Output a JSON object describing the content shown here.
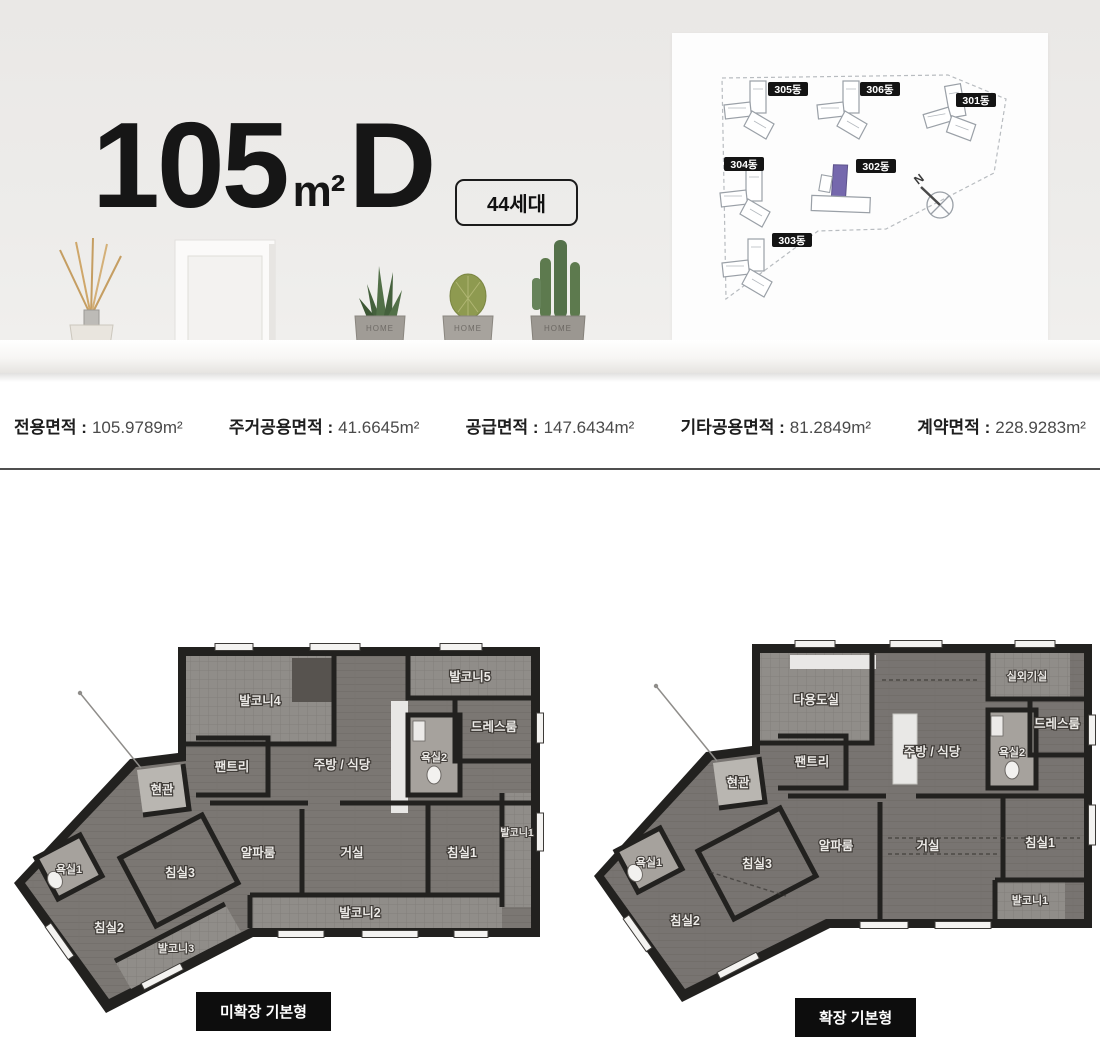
{
  "header": {
    "title_number": "105",
    "title_unit": "m²",
    "title_letter": "D",
    "badge": "44세대"
  },
  "site_map": {
    "buildings": [
      {
        "name": "305동"
      },
      {
        "name": "306동"
      },
      {
        "name": "301동"
      },
      {
        "name": "304동"
      },
      {
        "name": "302동"
      },
      {
        "name": "303동"
      }
    ],
    "highlighted_building": "302동",
    "highlight_color": "#7568ad",
    "compass_label": "N"
  },
  "decor": {
    "pot_label": "HOME"
  },
  "specs": [
    {
      "label": "전용면적 :",
      "value": "105.9789",
      "unit": "m²"
    },
    {
      "label": "주거공용면적 :",
      "value": "41.6645",
      "unit": "m²"
    },
    {
      "label": "공급면적 :",
      "value": "147.6434",
      "unit": "m²"
    },
    {
      "label": "기타공용면적 :",
      "value": "81.2849",
      "unit": "m²"
    },
    {
      "label": "계약면적 :",
      "value": "228.9283",
      "unit": "m²"
    }
  ],
  "plans": {
    "left": {
      "caption": "미확장 기본형",
      "rooms": {
        "balcony4": "발코니4",
        "balcony5": "발코니5",
        "dressroom": "드레스룸",
        "pantry": "팬트리",
        "kitchen": "주방 / 식당",
        "bath2": "욕실2",
        "entrance": "현관",
        "balcony1": "발코니1",
        "alpha": "알파룸",
        "living": "거실",
        "bed1": "침실1",
        "balcony2": "발코니2",
        "bed3": "침실3",
        "bath1": "욕실1",
        "bed2": "침실2",
        "balcony3": "발코니3"
      }
    },
    "right": {
      "caption": "확장 기본형",
      "rooms": {
        "utility": "다용도실",
        "acroom": "실외기실",
        "dressroom": "드레스룸",
        "pantry": "팬트리",
        "kitchen": "주방 / 식당",
        "bath2": "욕실2",
        "entrance": "현관",
        "alpha": "알파룸",
        "living": "거실",
        "bed1": "침실1",
        "balcony1": "발코니1",
        "bed3": "침실3",
        "bath1": "욕실1",
        "bed2": "침실2"
      }
    }
  }
}
